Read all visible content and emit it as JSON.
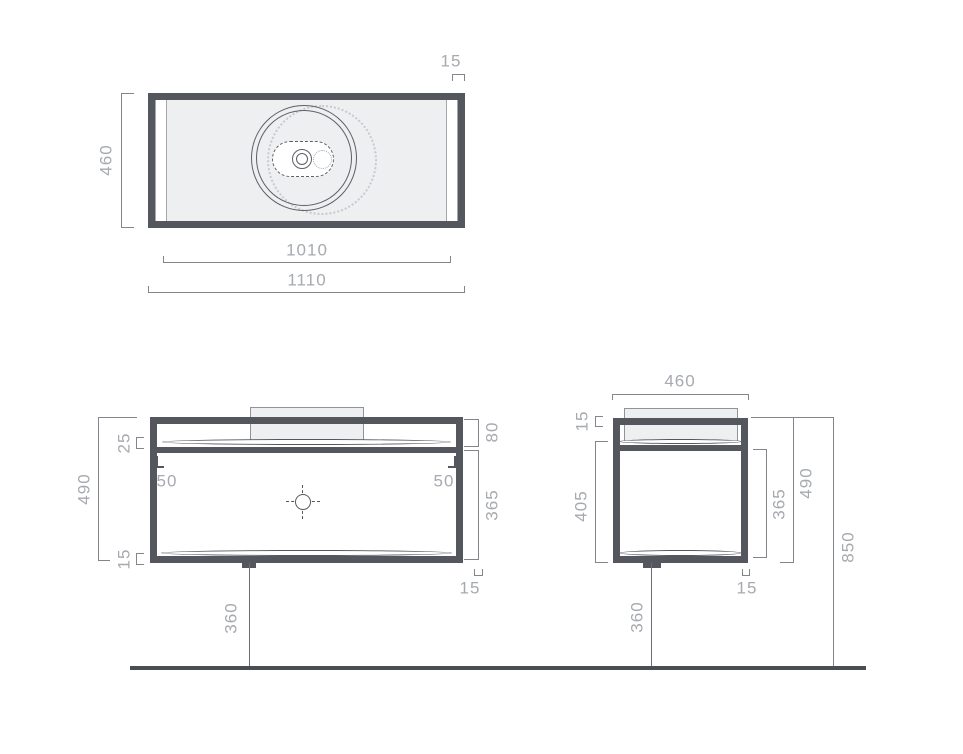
{
  "drawing": "vanity-unit-technical-drawing",
  "colors": {
    "frame": "#54575d",
    "surface_fill": "#edeff1",
    "dimension_line": "#82868c",
    "dimension_text": "#a6aaaf",
    "floor_line": "#4a4e54"
  },
  "top_view": {
    "depth_label": "460",
    "frame_label": "15",
    "inner_width_label": "1010",
    "outer_width_label": "1110"
  },
  "front_view": {
    "height_label": "490",
    "gap_label": "25",
    "bottom_frame_label": "15",
    "inset_left_label": "50",
    "inset_right_label": "50",
    "top_section_label": "80",
    "drawer_label": "365",
    "side_frame_label": "15",
    "drain_label": "360"
  },
  "side_view": {
    "depth_label": "460",
    "top_frame_label": "15",
    "inner_height_label": "405",
    "drawer_label": "365",
    "height_label": "490",
    "total_height_label": "850",
    "side_frame_label": "15",
    "drain_label": "360"
  }
}
